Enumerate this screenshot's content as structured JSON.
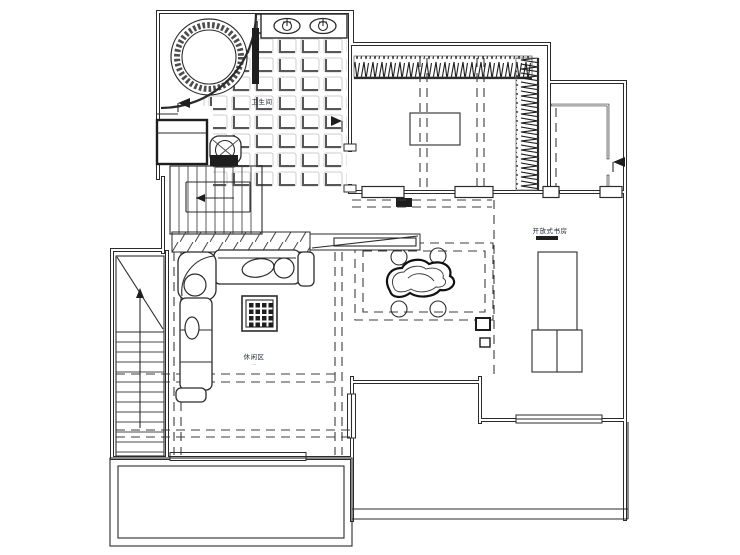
{
  "page": {
    "background": "#ffffff",
    "title": "residential floor plan drawing"
  },
  "plan": {
    "line_color": "#2b2b2b",
    "dash_color": "#3c3c3c",
    "labels": {
      "bathroom": {
        "main": "卫生间",
        "sub": "···"
      },
      "leisure": {
        "main": "休闲区",
        "sub": "···"
      },
      "study": {
        "main": "开放式书房"
      }
    },
    "fixtures": {
      "bathroom": [
        "round-jacuzzi-tub",
        "double-sink-vanity",
        "toilet",
        "shower-cabinet",
        "tile-floor"
      ],
      "bedroom": [
        "hatched-wardrobe-top",
        "hatched-wardrobe-right",
        "bed-table"
      ],
      "hall": [
        "void-dashed-border",
        "decor-stone",
        "downlights-x4"
      ],
      "leisure": [
        "l-shaped-sofa",
        "grid-coffee-table",
        "shelf-hatch-band"
      ],
      "study": [
        "desk",
        "two-chairs"
      ],
      "circulation": [
        "upper-staircase",
        "lower-staircase",
        "front-balcony",
        "side-balcony"
      ]
    }
  }
}
